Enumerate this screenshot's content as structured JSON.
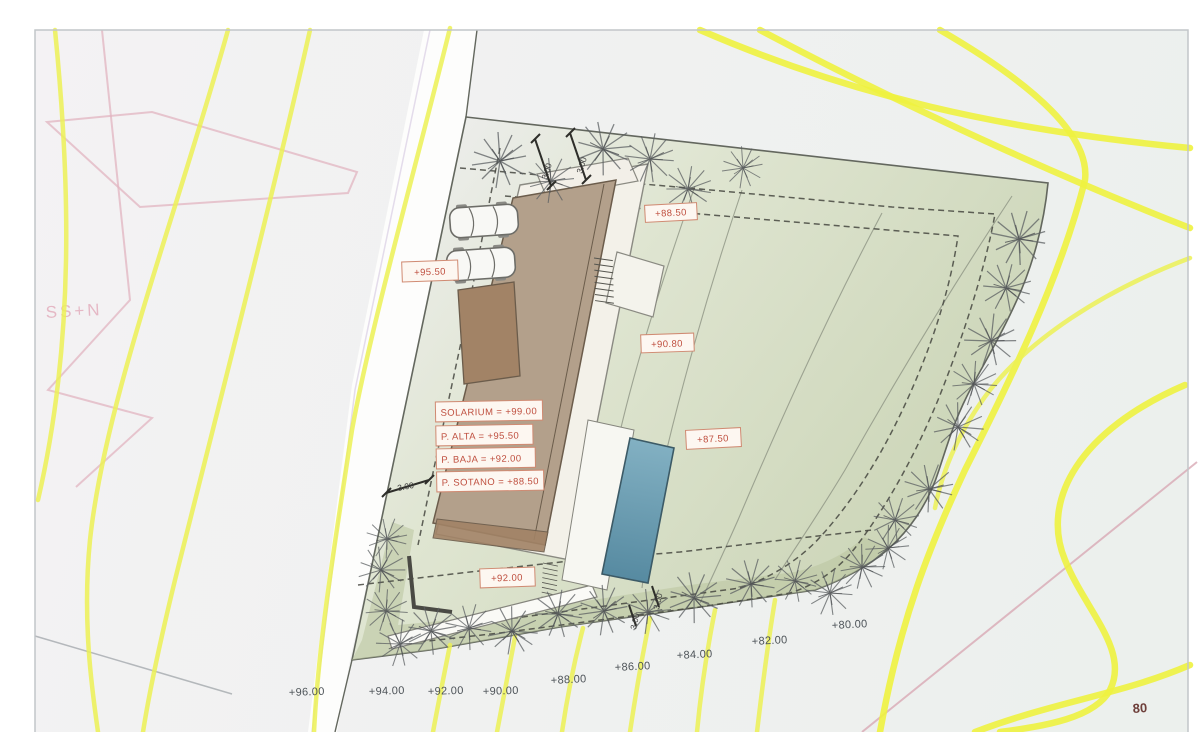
{
  "site_plan": {
    "levels": {
      "solarium": "SOLARIUM = +99.00",
      "p_alta": "P. ALTA = +95.50",
      "p_baja": "P. BAJA = +92.00",
      "p_sotano": "P. SOTANO = +88.50"
    },
    "spot_elevations": {
      "parking": "+95.50",
      "entrance": "+88.50",
      "mid_terrace": "+90.80",
      "pool_terrace": "+87.50",
      "lower_terrace": "+92.00"
    },
    "contour_labels": [
      "+96.00",
      "+94.00",
      "+92.00",
      "+90.00",
      "+88.00",
      "+86.00",
      "+84.00",
      "+82.00",
      "+80.00"
    ],
    "corner_contour": "80",
    "dimension_labels": {
      "d1": "3.00",
      "d2": "3.00",
      "d3": "3.00",
      "d4": "3.00",
      "d5": "3.00"
    },
    "neighbor_parcel_text": "SS+N",
    "colors": {
      "contour_yellow": "#ecf155",
      "parcel_green": "#ccd6b6",
      "building_tan": "#b3a08b",
      "building_dark": "#a28366",
      "pool_blue": "#6596ad",
      "label_red": "#bf4f3f",
      "neighbor_pink": "#e2b4c0"
    }
  }
}
